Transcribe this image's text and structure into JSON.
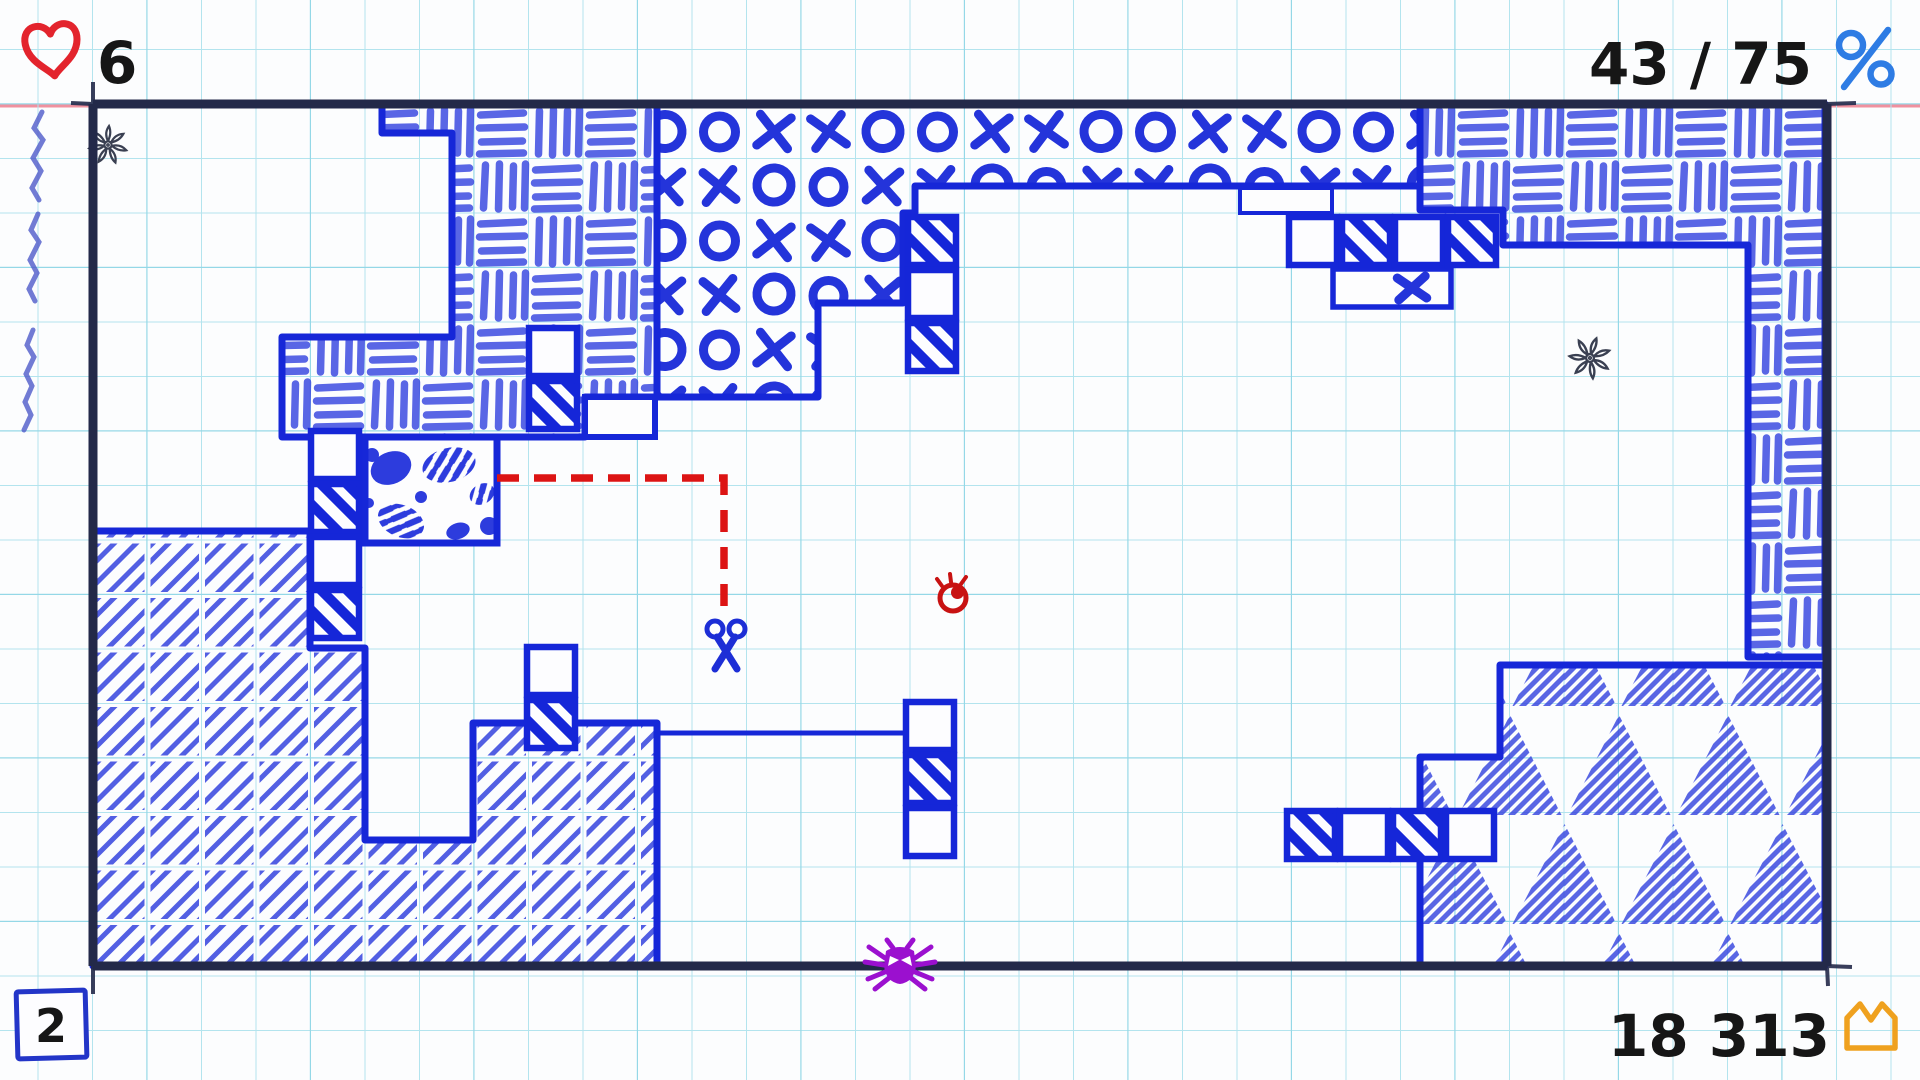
{
  "hud": {
    "lives_count": "6",
    "progress": "43 / 75",
    "level": "2",
    "score": "18 313"
  },
  "icons": {
    "lives": "heart-icon",
    "progress": "percent-icon",
    "score": "crown-icon"
  },
  "colors": {
    "pen_blue": "#1c2bd8",
    "pattern_blue": "#2d3cdd",
    "ink_red": "#dc1414",
    "heart_red": "#e3242d",
    "spider_purple": "#9b10cf",
    "crown_orange": "#efa11f",
    "percent_blue": "#2e7ce4",
    "grid_cyan": "#aee2ec",
    "border_navy": "#232949",
    "margin_pink": "#f0919f"
  },
  "game": {
    "player": {
      "type": "scissors",
      "x": 726,
      "y": 640
    },
    "cut_path_points": "497,478 724,478 724,606",
    "enemies": [
      {
        "type": "eyeball",
        "x": 953,
        "y": 598
      },
      {
        "type": "spider",
        "x": 900,
        "y": 964
      }
    ],
    "regions": [
      {
        "name": "top-left",
        "pattern": "basket-weave"
      },
      {
        "name": "top-center",
        "pattern": "x-and-o"
      },
      {
        "name": "top-right",
        "pattern": "basket-weave"
      },
      {
        "name": "bottom-left",
        "pattern": "diagonal-crosshatch"
      },
      {
        "name": "bottom-right",
        "pattern": "hatched-triangles"
      },
      {
        "name": "mid-left-small",
        "pattern": "spots"
      }
    ],
    "doodles": [
      "flower",
      "flower",
      "pencil-scribble"
    ]
  }
}
